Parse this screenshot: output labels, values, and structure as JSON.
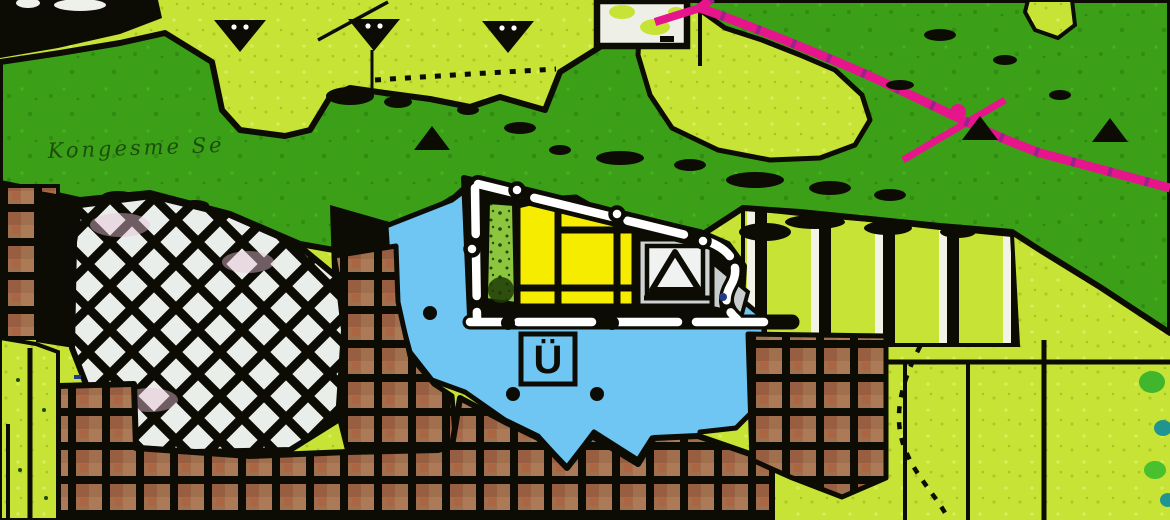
{
  "map": {
    "title": "land-use-plan-extract",
    "street_label": {
      "text": "Kongesme Se"
    },
    "overlay_marker": {
      "label": "Ü"
    },
    "colors": {
      "forest_green": "#3ba017",
      "open_land_chartreuse": "#c6e336",
      "flood_overlay_blue": "#6fc6f3",
      "planned_area_yellow": "#f6ec00",
      "built_area_brown": "#a06f4e",
      "mixed_area_white": "#eaeeea",
      "power_line_pink": "#e6158c",
      "green_strip": "#8cc53e",
      "line_black": "#0d0c04",
      "facility_box_silver": "#ced2d2"
    },
    "symbols": {
      "down_triangle_tree_markers": 3,
      "up_triangle_tree_markers": 3,
      "facility_symbol": "triangle-in-square",
      "road_loop": "white-dashed-planned-road",
      "overlay_boundary": "black-dot-markers"
    }
  }
}
